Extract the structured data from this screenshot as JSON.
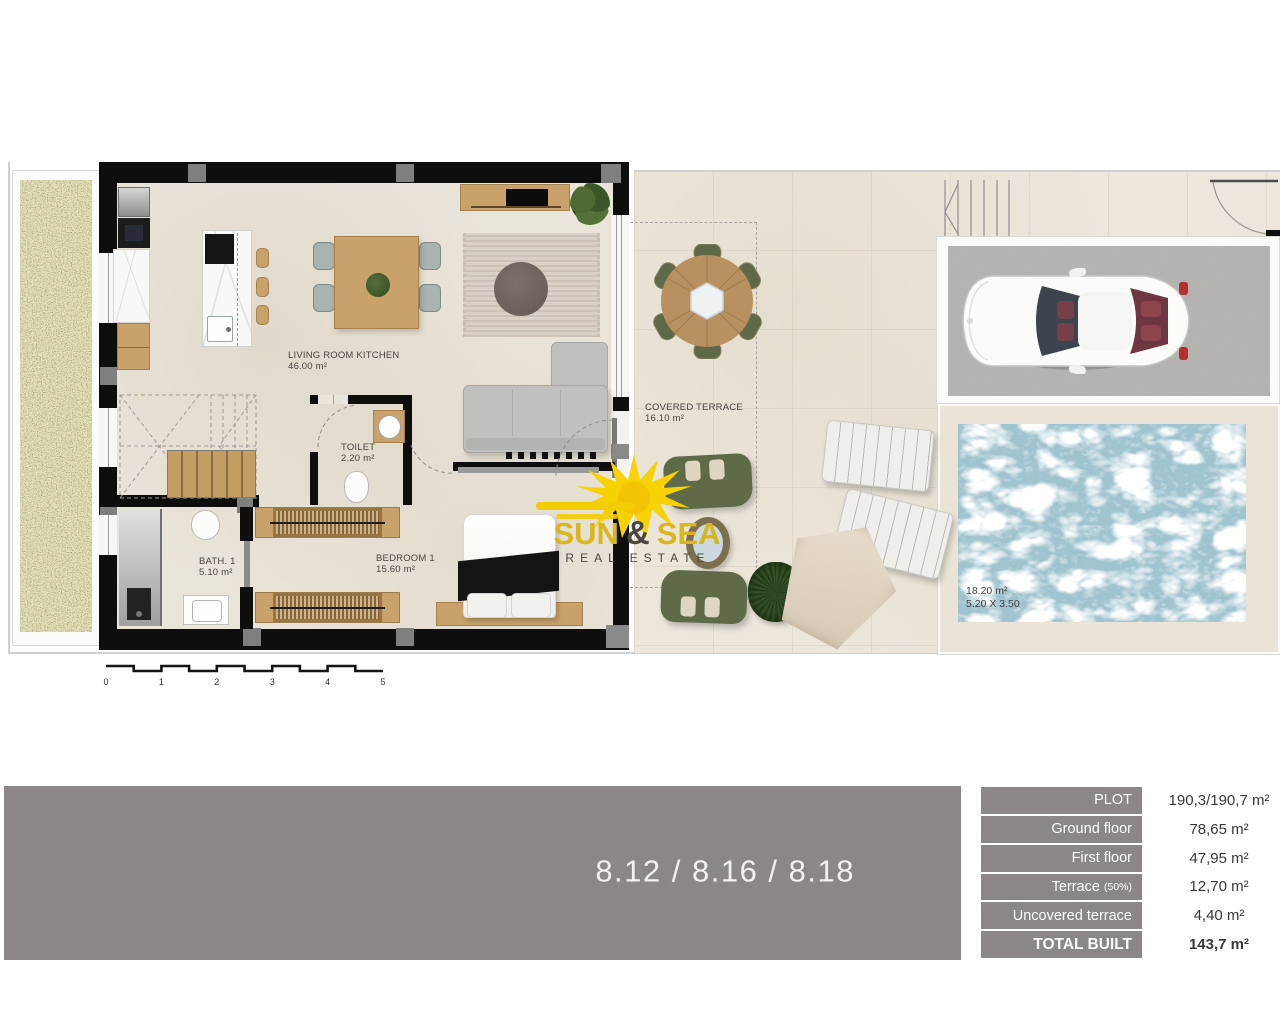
{
  "plan": {
    "labels": {
      "living": {
        "name": "LIVING ROOM KITCHEN",
        "area": "46.00 m²"
      },
      "toilet": {
        "name": "TOILET",
        "area": "2.20 m²"
      },
      "bath": {
        "name": "BATH. 1",
        "area": "5.10 m²"
      },
      "bedroom": {
        "name": "BEDROOM 1",
        "area": "15.60 m²"
      },
      "covered_terrace": {
        "name": "COVERED TERRACE",
        "area": "16.10 m²"
      },
      "pool": {
        "area": "18.20 m²",
        "dimensions": "5.20 X 3.50"
      }
    },
    "scale_bar": {
      "labels": [
        "0",
        "1",
        "2",
        "3",
        "4",
        "5"
      ]
    }
  },
  "logo": {
    "word1": "SUN",
    "amp": "&",
    "word2": "SEA",
    "subtitle": "REAL ESTATE"
  },
  "unit_numbers": "8.12 / 8.16 / 8.18",
  "area_table": {
    "rows": [
      {
        "label": "PLOT",
        "value": "190,3/190,7 m²"
      },
      {
        "label": "Ground floor",
        "value": "78,65 m²"
      },
      {
        "label": "First floor",
        "value": "47,95 m²"
      },
      {
        "label": "Terrace",
        "label_suffix": "(50%)",
        "value": "12,70 m²"
      },
      {
        "label": "Uncovered terrace",
        "value": "4,40 m²"
      },
      {
        "label": "TOTAL BUILT",
        "value": "143,7 m²"
      }
    ]
  },
  "colors": {
    "band_gray": "#8b8786",
    "wall_black": "#0e0e0e",
    "pool_blue": "#9fc3cf",
    "grass_green": "#8e8b51",
    "logo_gold": "#d9b51e",
    "sun_yellow": "#f7d103"
  }
}
